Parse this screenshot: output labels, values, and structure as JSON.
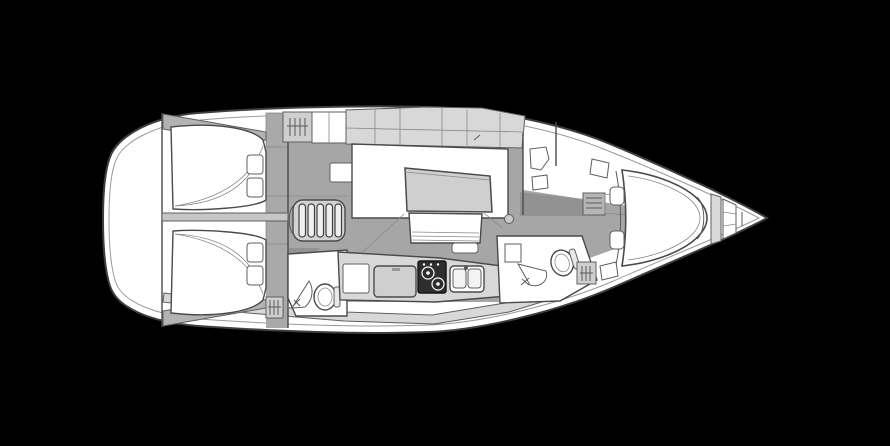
{
  "diagram": {
    "kind": "sailing-yacht-interior-deck-plan",
    "orientation": "bow-right",
    "colors": {
      "background": "#000000",
      "hull": "#ffffff",
      "outline": "#3f3f3f",
      "outline_soft": "#9a9a9a",
      "floor": "#a6a6a6",
      "floor_dark": "#929292",
      "furniture": "#d8d8d8",
      "furniture_mid": "#cfcfcf",
      "shelf": "#b5b5b5",
      "divider": "#c6c6c6",
      "steps_frame": "#d2d2d2",
      "stove": "#2e2e2e"
    },
    "regions": [
      {
        "name": "transom-stern"
      },
      {
        "name": "aft-cabin-port",
        "features": [
          "double-berth",
          "2-pillows",
          "stowage-shelf"
        ]
      },
      {
        "name": "aft-cabin-starboard",
        "features": [
          "double-berth",
          "2-pillows",
          "stowage-shelf"
        ]
      },
      {
        "name": "companionway",
        "features": [
          "5-step-ladder",
          "hanging-locker",
          "cabinet",
          "seat"
        ]
      },
      {
        "name": "aft-head",
        "features": [
          "toilet",
          "sink",
          "hanging-locker"
        ]
      },
      {
        "name": "salon",
        "features": [
          "u-settee",
          "table",
          "bench-seat",
          "footrest"
        ]
      },
      {
        "name": "galley",
        "features": [
          "2-burner-stove",
          "double-sink",
          "fridge",
          "locker"
        ]
      },
      {
        "name": "forward-head",
        "features": [
          "toilet",
          "sink",
          "hanging-locker"
        ]
      },
      {
        "name": "passageway",
        "features": [
          "shelf-unit",
          "wardrobe"
        ]
      },
      {
        "name": "forward-cabin",
        "features": [
          "v-berth",
          "side-benches",
          "side-pads"
        ]
      },
      {
        "name": "anchor-locker"
      },
      {
        "name": "bow"
      }
    ],
    "fixture_counts": {
      "berths": 3,
      "toilets": 2,
      "bathroom_sinks": 2,
      "galley_sink_basins": 2,
      "stove_burners": 2,
      "hanging_lockers": 3,
      "pillows": 4,
      "companionway_steps": 5
    }
  }
}
